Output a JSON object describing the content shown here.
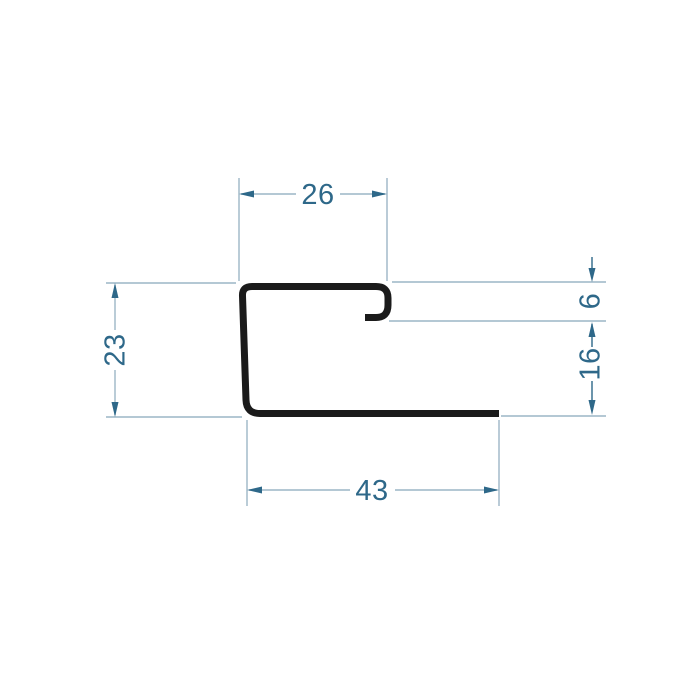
{
  "drawing": {
    "background_color": "#ffffff",
    "profile_color": "#1b1b1b",
    "dimension_line_color": "#9cb5c6",
    "dimension_accent_color": "#2e6889",
    "dimensions": {
      "top_width": "26",
      "left_height": "23",
      "hook_height": "6",
      "right_height": "16",
      "bottom_width": "43"
    }
  }
}
